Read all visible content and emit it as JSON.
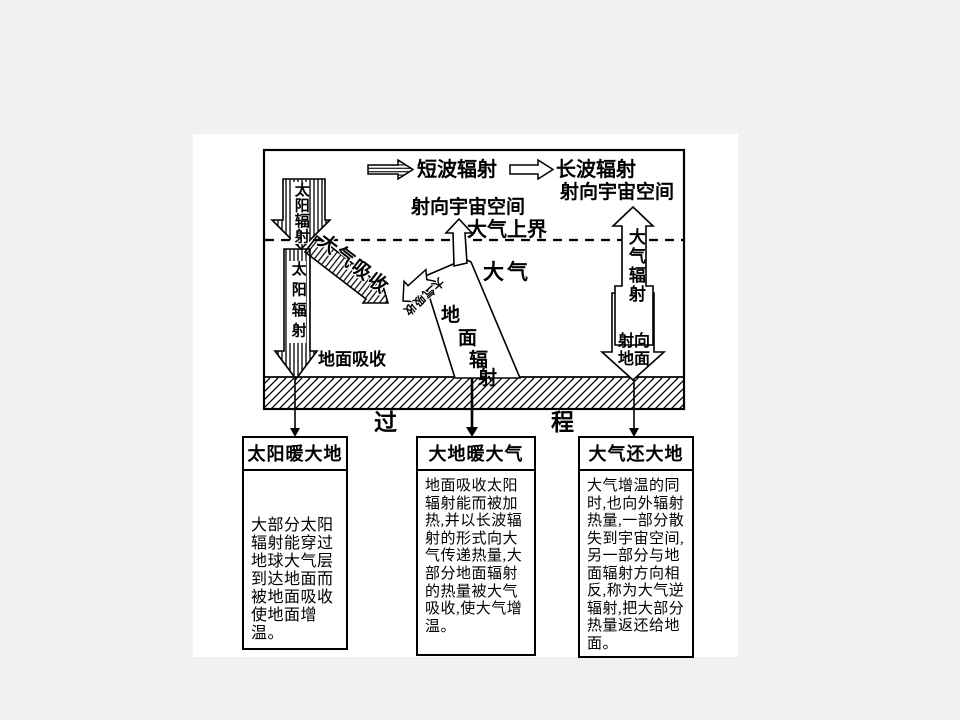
{
  "colors": {
    "page_bg": "#f1f1f1",
    "paper": "#ffffff",
    "ink": "#000000"
  },
  "legend": {
    "shortwave": "短波辐射",
    "longwave": "长波辐射"
  },
  "labels": {
    "to_space_right": "射向宇宙空间",
    "to_space_mid": "射向宇宙空间",
    "atmosphere_top": "大气上界",
    "atmosphere": "大气",
    "solar_radiation_upper": "太阳辐射",
    "solar_radiation_lower": "太阳辐射",
    "atmosphere_absorption": "大气吸收",
    "atmosphere_absorption_branch": "大气吸收",
    "ground_absorption": "地面吸收",
    "ground_radiation": "地面辐射",
    "atmosphere_radiation": "大气辐射",
    "to_ground": "射向地面",
    "process_left": "过",
    "process_right": "程"
  },
  "boxes": [
    {
      "title": "太阳暖大地",
      "body": "大部分太阳\n辐射能穿过\n地球大气层\n到达地面而\n被地面吸收\n使地面增温。"
    },
    {
      "title": "大地暖大气",
      "body": "地面吸收太阳\n辐射能而被加\n热,并以长波辐\n射的形式向大\n气传递热量,大\n部分地面辐射\n的热量被大气\n吸收,使大气增\n温。"
    },
    {
      "title": "大气还大地",
      "body": "大气增温的同\n时,也向外辐射\n热量,一部分散\n失到宇宙空间,\n另一部分与地\n面辐射方向相\n反,称为大气逆\n辐射,把大部分\n热量返还给地\n面。"
    }
  ]
}
